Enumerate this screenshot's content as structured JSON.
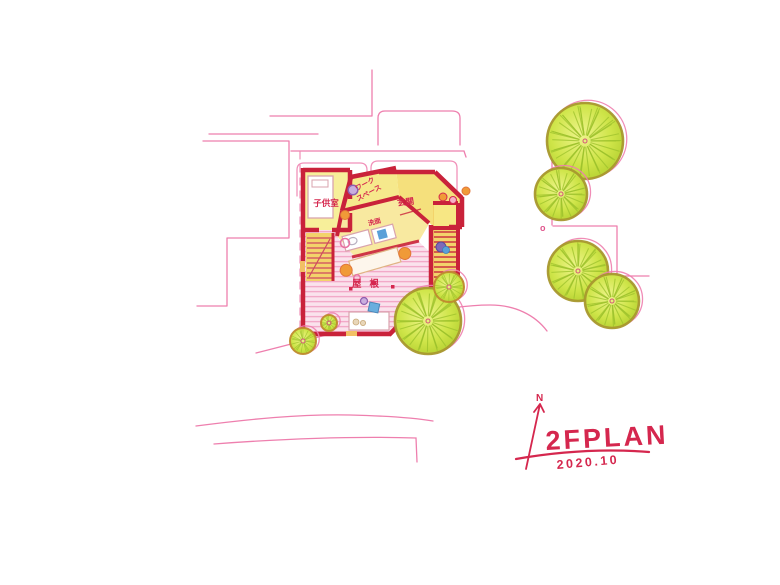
{
  "drawing": {
    "kind": "hand-drawn 2nd-floor architectural plan sketch",
    "floor_title": "2FPLAN",
    "date": "2020.10",
    "north_label": "N",
    "site_marker": "o"
  },
  "rooms": {
    "kids_room": "子供室",
    "workspace_line1": "ワーク",
    "workspace_line2": "スペース",
    "entrance": "玄関",
    "washroom": "洗面",
    "roof_deck": "屋根"
  },
  "colors": {
    "wall_red": "#c9223a",
    "accent_red": "#d5274e",
    "line_pink": "#ee7fae",
    "deck_stripe_pink": "#f2a9c8",
    "room_yellow": "#f6e98c",
    "stair_yellow": "#f3d36b",
    "tree_green": "#c3dc38",
    "tree_line_green": "#9dc22c",
    "tree_ring_olive": "#a8982e",
    "bush_ring_brown": "#bf8a2e",
    "furniture_blue": "#5aa0d8",
    "furniture_purple": "#8d5fb0",
    "stool_orange": "#f09a38"
  },
  "site": {
    "trees": [
      {
        "cx": 585,
        "cy": 141,
        "r": 38
      },
      {
        "cx": 561,
        "cy": 194,
        "r": 26
      },
      {
        "cx": 578,
        "cy": 271,
        "r": 30
      },
      {
        "cx": 612,
        "cy": 301,
        "r": 27
      },
      {
        "cx": 428,
        "cy": 321,
        "r": 33
      }
    ],
    "bushes": [
      {
        "cx": 303,
        "cy": 341,
        "r": 13
      },
      {
        "cx": 449,
        "cy": 287,
        "r": 15
      },
      {
        "cx": 329,
        "cy": 323,
        "r": 8
      }
    ]
  }
}
